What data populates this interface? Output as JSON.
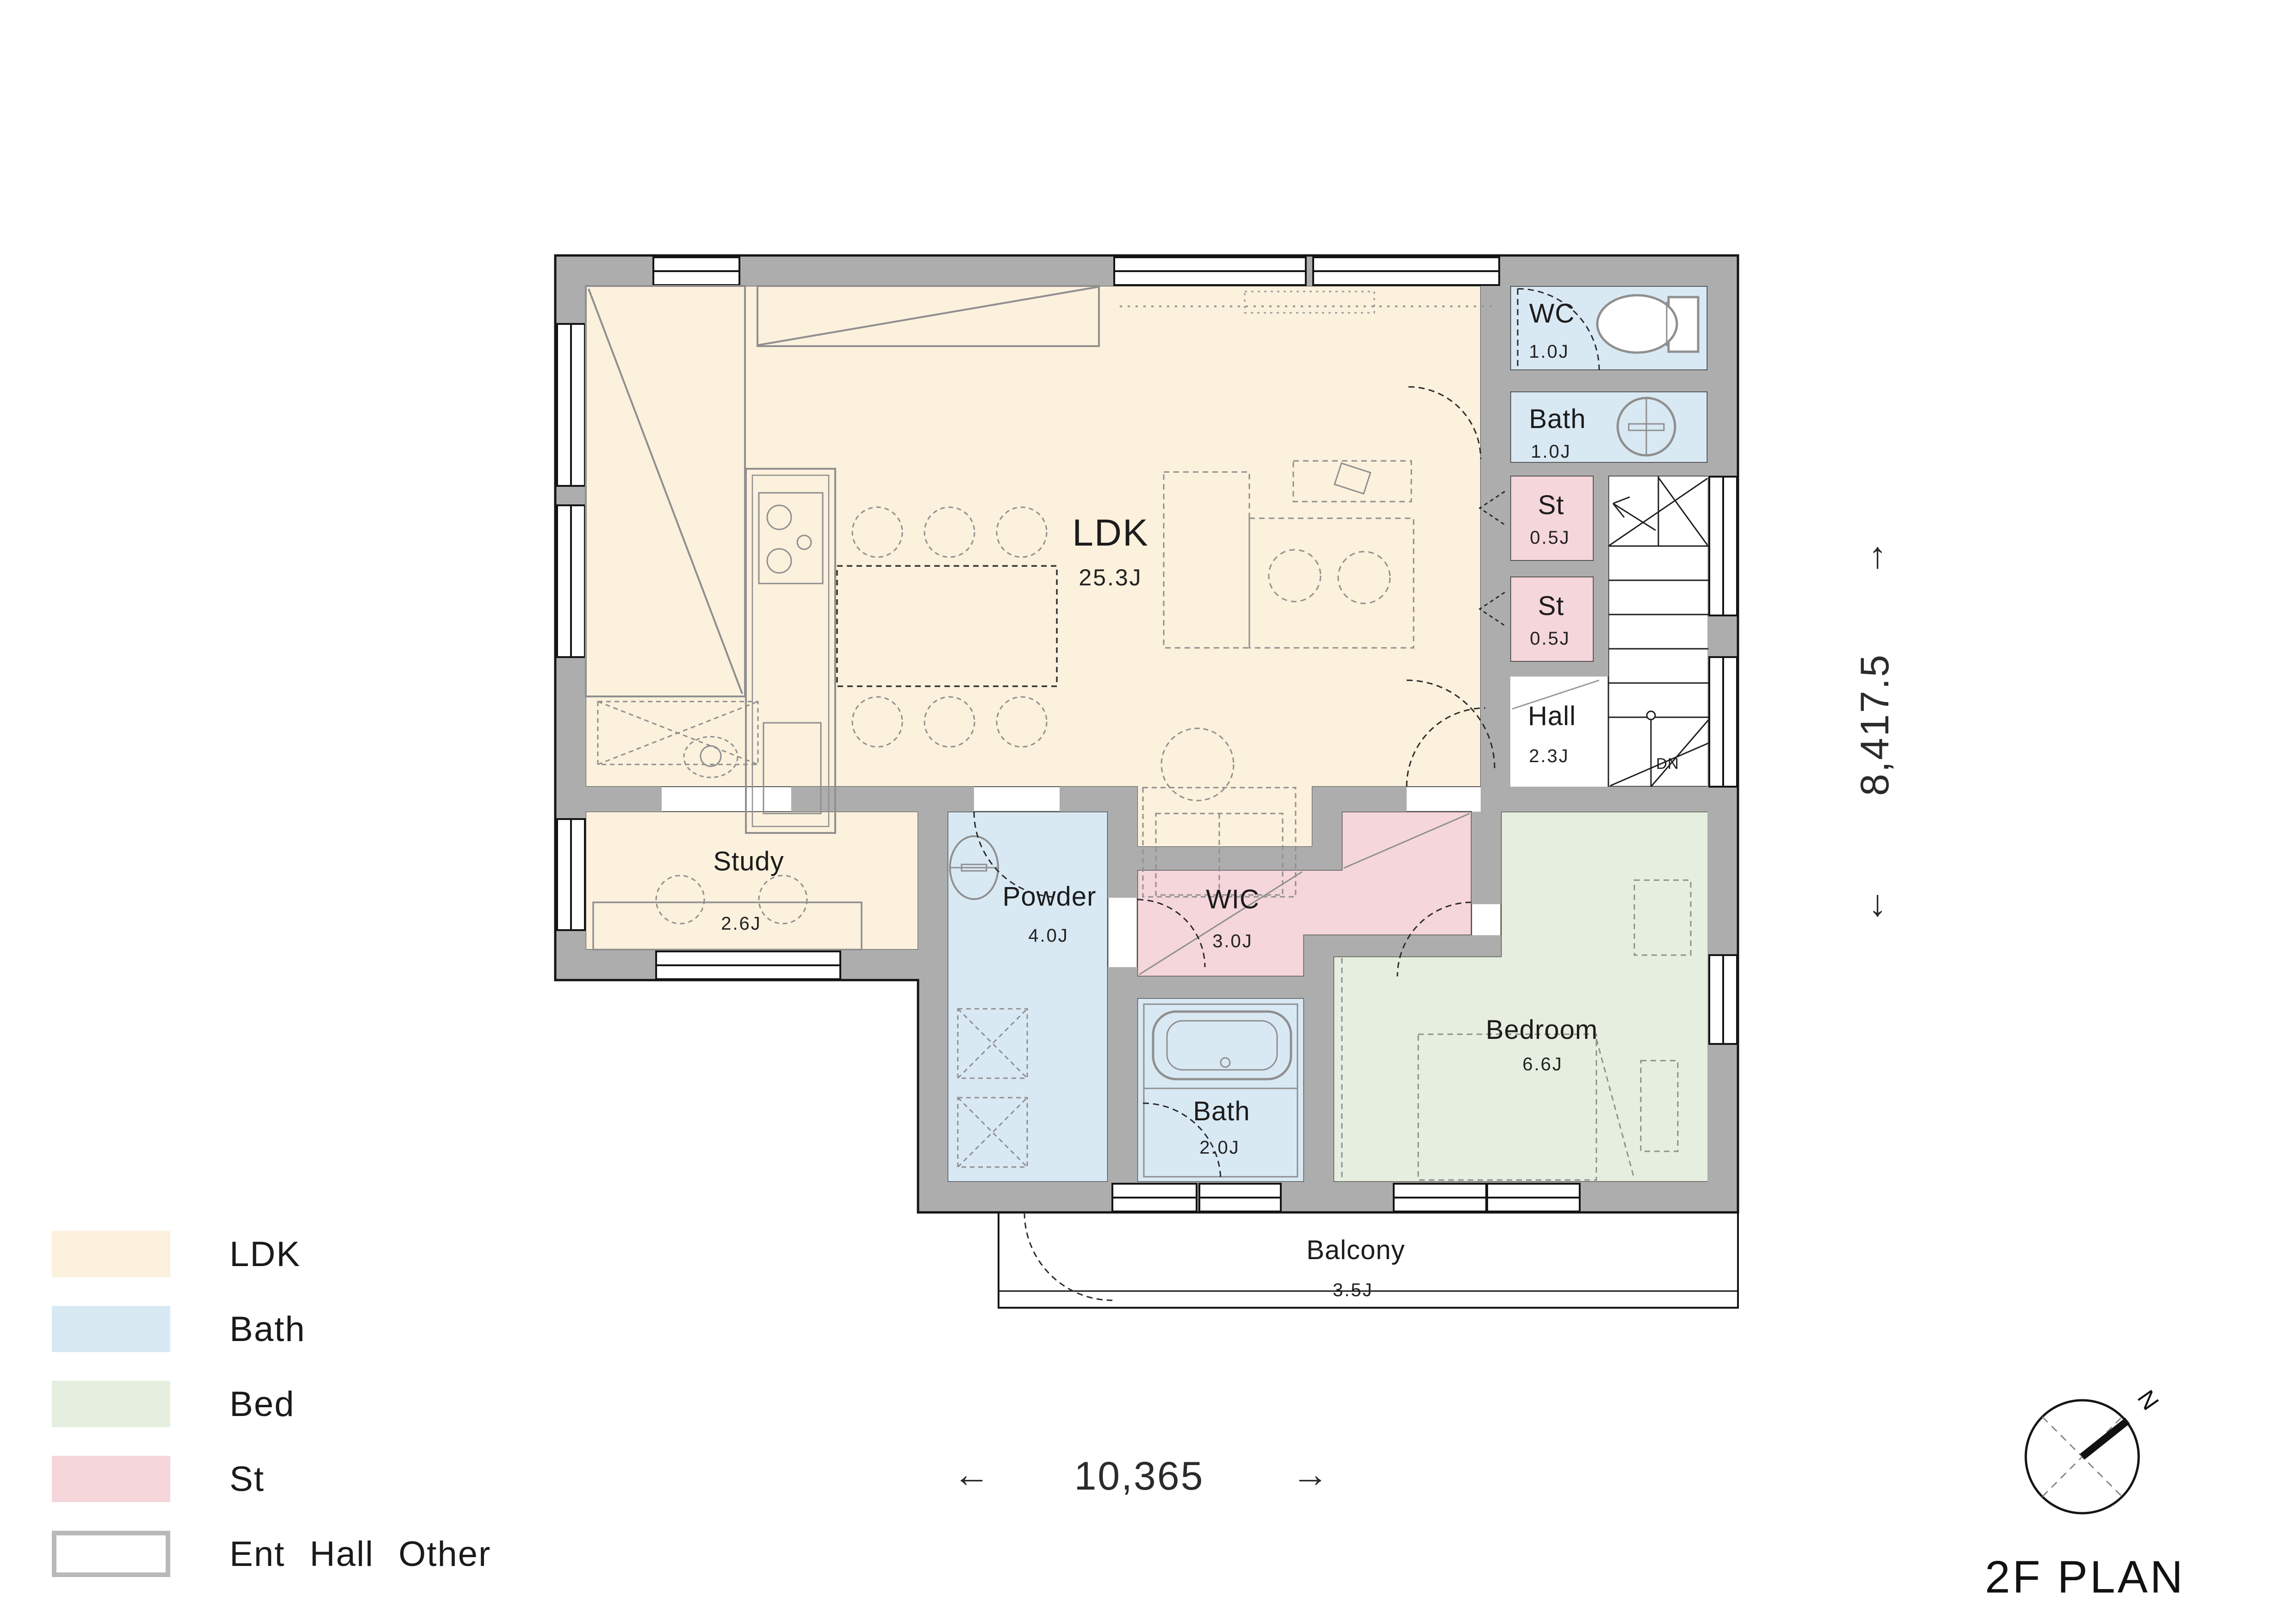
{
  "title": "2F PLAN",
  "compass": {
    "north_label": "N"
  },
  "dimensions": {
    "width_label": "10,365",
    "width_arrow_left": "←",
    "width_arrow_right": "→",
    "height_label": "8,417.5",
    "height_arrow_up": "↑",
    "height_arrow_down": "↓"
  },
  "stairs": {
    "down_label": "DN"
  },
  "rooms": [
    {
      "id": "ldk",
      "name": "LDK",
      "area": "25.3J"
    },
    {
      "id": "wc",
      "name": "WC",
      "area": "1.0J"
    },
    {
      "id": "bath-1f",
      "name": "Bath",
      "area": "1.0J"
    },
    {
      "id": "st-1",
      "name": "St",
      "area": "0.5J"
    },
    {
      "id": "st-2",
      "name": "St",
      "area": "0.5J"
    },
    {
      "id": "hall",
      "name": "Hall",
      "area": "2.3J"
    },
    {
      "id": "study",
      "name": "Study",
      "area": "2.6J"
    },
    {
      "id": "powder",
      "name": "Powder",
      "area": "4.0J"
    },
    {
      "id": "wic",
      "name": "WIC",
      "area": "3.0J"
    },
    {
      "id": "bath-2",
      "name": "Bath",
      "area": "2.0J"
    },
    {
      "id": "bedroom",
      "name": "Bedroom",
      "area": "6.6J"
    },
    {
      "id": "balcony",
      "name": "Balcony",
      "area": "3.5J"
    }
  ],
  "legend": [
    {
      "label": "LDK",
      "color": "#fbf1dc"
    },
    {
      "label": "Bath",
      "color": "#d9e9f4"
    },
    {
      "label": "Bed",
      "color": "#e6efdf"
    },
    {
      "label": "St",
      "color": "#f5d6da"
    },
    {
      "label": "Ent Hall Other",
      "color": "#ffffff"
    }
  ],
  "colors": {
    "wall": "#adadad",
    "outline": "#141414",
    "ldk": "#fbf1dc",
    "bath": "#d9e9f4",
    "bed": "#e6efdf",
    "st": "#f5d6da",
    "other": "#ffffff",
    "furniture_line": "#8f8f8f"
  }
}
